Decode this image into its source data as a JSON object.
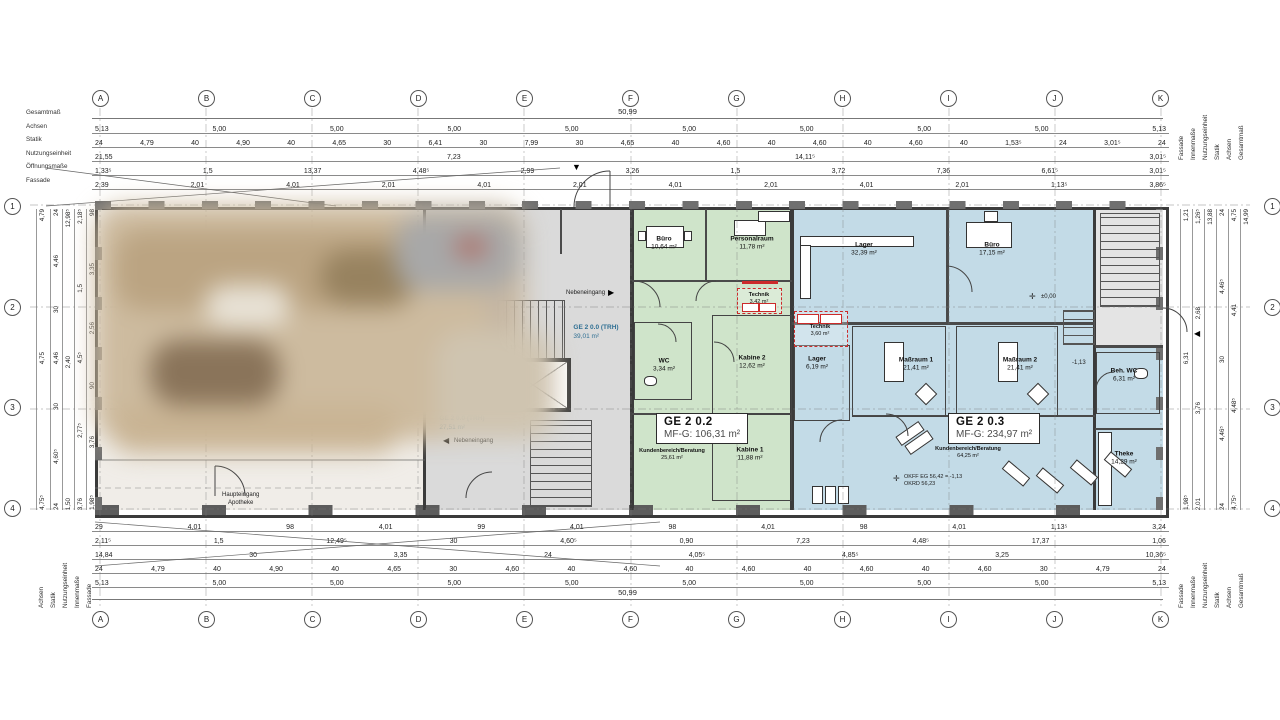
{
  "axes": {
    "cols": [
      "A",
      "B",
      "C",
      "D",
      "E",
      "F",
      "G",
      "H",
      "I",
      "J",
      "K"
    ],
    "rows": [
      "1",
      "2",
      "3",
      "4"
    ]
  },
  "dim_labels": {
    "top_left": [
      "Gesamtmaß",
      "Achsen",
      "Statik",
      "Nutzungseinheit",
      "Öffnungsmaße",
      "Fassade"
    ],
    "bottom_left": [
      "Achsen",
      "Statik",
      "Nutzungseinheit",
      "Innenmaße",
      "Fassade"
    ],
    "top_right": [
      "Fassade",
      "Innenmaße",
      "Nutzungseinheit",
      "Statik",
      "Achsen",
      "Gesamtmaß"
    ],
    "bottom_right": [
      "Fassade",
      "Innenmaße",
      "Nutzungseinheit",
      "Statik",
      "Achsen",
      "Gesamtmaß"
    ]
  },
  "dims": {
    "total_length": "50,99",
    "total_height": "14,99",
    "top": {
      "achsen": [
        "5,13",
        "5,00",
        "5,00",
        "5,00",
        "5,00",
        "5,00",
        "5,00",
        "5,00",
        "5,00",
        "5,13"
      ],
      "statik": [
        "24",
        "4,79",
        "40",
        "4,90",
        "40",
        "4,65",
        "30",
        "6,41",
        "30",
        "7,99",
        "30",
        "4,65",
        "40",
        "4,60",
        "40",
        "4,60",
        "40",
        "4,60",
        "40",
        "1,53⁵",
        "24",
        "3,01⁵",
        "24"
      ],
      "nutzungseinheit": [
        "21,55",
        "7,23",
        "14,11⁵",
        "3,01⁵"
      ],
      "oeffnungen": [
        "1,33⁵",
        "1,5",
        "13,37",
        "4,48⁵",
        "2,99",
        "3,26",
        "1,5",
        "3,72",
        "7,36",
        "6,61⁵",
        "3,01⁵"
      ],
      "fassade": [
        "2,39",
        "2,01",
        "4,01",
        "2,01",
        "4,01",
        "2,01",
        "4,01",
        "2,01",
        "4,01",
        "2,01",
        "1,13⁵",
        "3,86⁵"
      ]
    },
    "bottom": {
      "fassade": [
        "29",
        "4,01",
        "98",
        "4,01",
        "99",
        "4,01",
        "98",
        "4,01",
        "98",
        "4,01",
        "1,13⁵",
        "3,24"
      ],
      "innenmasse": [
        "2,11⁵",
        "1,5",
        "12,49⁵",
        "30",
        "4,60⁵",
        "0,90",
        "7,23",
        "4,48⁵",
        "17,37",
        "1,06"
      ],
      "nutzungseinheit": [
        "14,84",
        "30",
        "3,35",
        "24",
        "4,05⁵",
        "4,85⁵",
        "3,25",
        "10,36⁵"
      ],
      "statik": [
        "24",
        "4,79",
        "40",
        "4,90",
        "40",
        "4,65",
        "30",
        "4,60",
        "40",
        "4,60",
        "40",
        "4,60",
        "40",
        "4,60",
        "40",
        "4,60",
        "30",
        "4,79",
        "24"
      ],
      "achsen": [
        "5,13",
        "5,00",
        "5,00",
        "5,00",
        "5,00",
        "5,00",
        "5,00",
        "5,00",
        "5,00",
        "5,13"
      ]
    },
    "left": {
      "achsen": [
        "4,79",
        "4,75",
        "4,75⁵"
      ],
      "statik": [
        "24",
        "4,46",
        "30",
        "4,46",
        "30",
        "4,60⁵",
        "24"
      ],
      "nutzungseinheit": [
        "12,98⁵",
        "2,40",
        "1,50"
      ],
      "innenmasse": [
        "2,18⁵",
        "1,5",
        "4,5⁵",
        "2,77⁵",
        "3,76"
      ],
      "fassade": [
        "98",
        "3,35",
        "2,56",
        "90",
        "3,76",
        "1,98⁵"
      ]
    },
    "right": {
      "achsen": [
        "4,75",
        "4,41",
        "4,48⁵",
        "4,75⁵"
      ],
      "statik": [
        "24",
        "4,46⁵",
        "30",
        "4,46⁵",
        "24"
      ],
      "nutzungseinheit": [
        "13,88"
      ],
      "innenmasse": [
        "1,26⁵",
        "2,68",
        "3,76",
        "2,01"
      ],
      "fassade": [
        "1,21",
        "6,31",
        "1,98⁵"
      ]
    }
  },
  "units": {
    "trh_upper": {
      "name": "GE 2 0.0 (TRH)",
      "area": "39,01 m²"
    },
    "trh_lower": {
      "name": "GE 2 0.0 (TRH)",
      "area": "27,51 m²"
    },
    "ge202": {
      "title": "GE 2 0.2",
      "mfg": "MF-G: 106,31 m²",
      "rooms": [
        {
          "name": "Büro",
          "area": "10,64 m²"
        },
        {
          "name": "Personalraum",
          "area": "11,78 m²"
        },
        {
          "name": "Technik",
          "area": "3,42 m²"
        },
        {
          "name": "WC",
          "area": "3,34 m²"
        },
        {
          "name": "Kabine 2",
          "area": "12,62 m²"
        },
        {
          "name": "Kundenbereich/Beratung",
          "area": "25,61 m²"
        },
        {
          "name": "Kabine 1",
          "area": "11,88 m²"
        }
      ]
    },
    "ge203": {
      "title": "GE 2 0.3",
      "mfg": "MF-G: 234,97 m²",
      "rooms": [
        {
          "name": "Lager",
          "area": "32,39 m²"
        },
        {
          "name": "Büro",
          "area": "17,15 m²"
        },
        {
          "name": "Technik",
          "area": "3,60 m²"
        },
        {
          "name": "Lager",
          "area": "6,19 m²"
        },
        {
          "name": "Maßraum 1",
          "area": "21,41 m²"
        },
        {
          "name": "Maßraum 2",
          "area": "21,41 m²"
        },
        {
          "name": "Kundenbereich/Beratung",
          "area": "64,25 m²"
        },
        {
          "name": "Beh. WC",
          "area": "6,31 m²"
        },
        {
          "name": "Theke",
          "area": "14,29 m²"
        }
      ]
    }
  },
  "annotations": {
    "okff_line1": "OKFF EG 56,42 = -1,13",
    "okff_line2": "OKRD 56,23",
    "level_zero": "±0,00",
    "level_minus": "-1,13",
    "nebeneingang": "Nebeneingang",
    "haupteingang": "Haupteingang",
    "haupteingang_sub": "Apotheke"
  },
  "colors": {
    "green_zone": "#cfe4ca",
    "blue_zone": "#c3dbe7",
    "gray_zone": "#dadada",
    "wall": "#3b3b3b",
    "red_accent": "#cc2a2a",
    "trh_text": "#2f6f93"
  }
}
